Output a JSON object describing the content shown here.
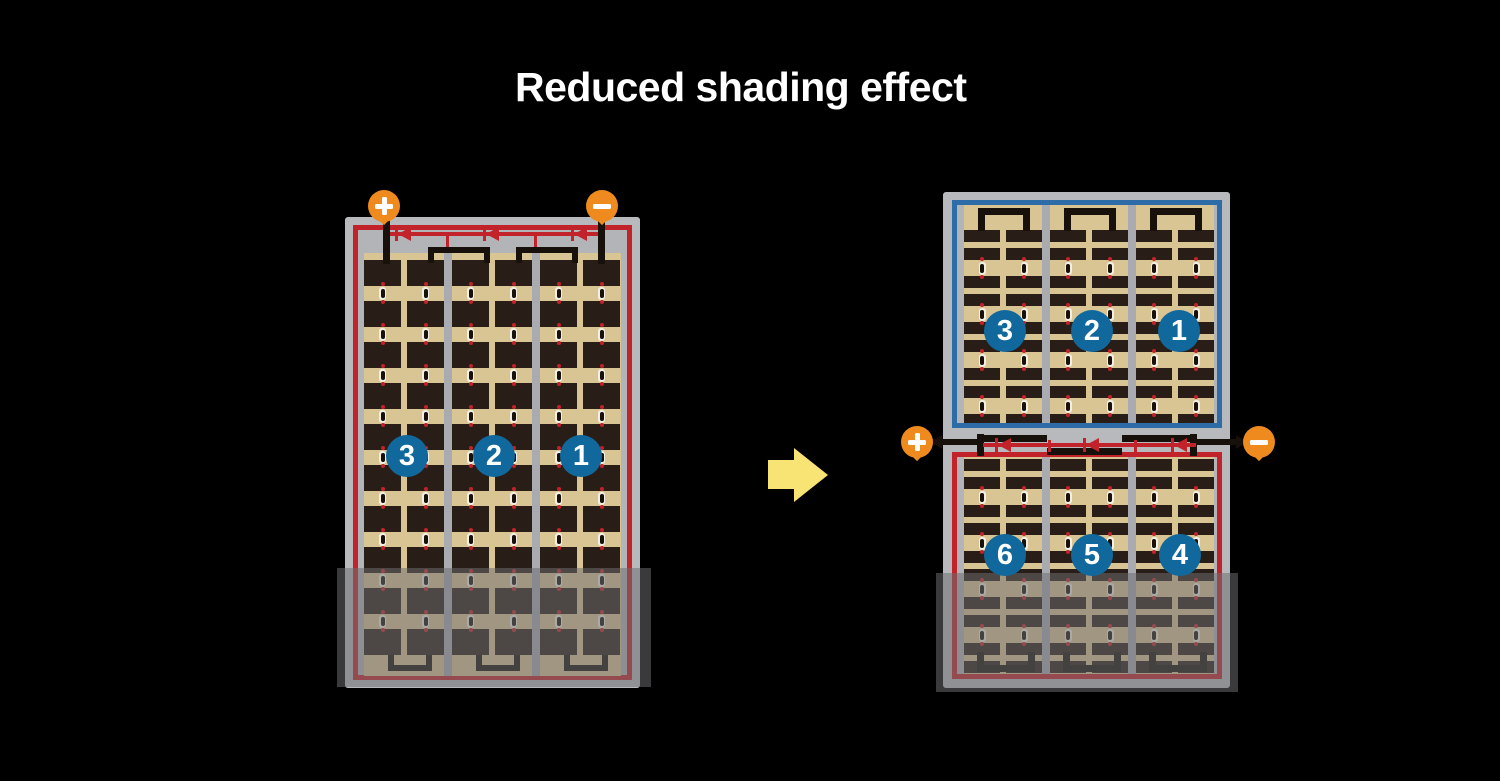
{
  "title": "Reduced shading effect",
  "left_module": {
    "terminals": {
      "positive": "+",
      "negative": "−"
    },
    "cell_strings": [
      "3",
      "2",
      "1"
    ],
    "bypass_diodes": 3,
    "grid": {
      "columns": 6,
      "rows": 10
    },
    "shaded_rows": 2
  },
  "right_module": {
    "terminals": {
      "positive": "+",
      "negative": "−"
    },
    "top_half": {
      "cell_strings": [
        "3",
        "2",
        "1"
      ],
      "grid": {
        "columns": 6,
        "bar_rows": 10
      }
    },
    "bottom_half": {
      "cell_strings": [
        "6",
        "5",
        "4"
      ],
      "grid": {
        "columns": 6,
        "bar_rows": 10
      }
    },
    "bypass_diodes": 3
  },
  "colors": {
    "background": "#000000",
    "title_text": "#ffffff",
    "panel_frame": "#b8b9bc",
    "cell_tan": "#d9c493",
    "cell_dark": "#291e17",
    "circuit_red": "#c2222a",
    "string_blue": "#2e6ca7",
    "badge_blue": "#11689c",
    "terminal_orange": "#ee8a1e",
    "arrow_yellow": "#f8e375",
    "wire_black": "#17100b",
    "shade_overlay": "rgba(110,110,113,0.53)"
  }
}
